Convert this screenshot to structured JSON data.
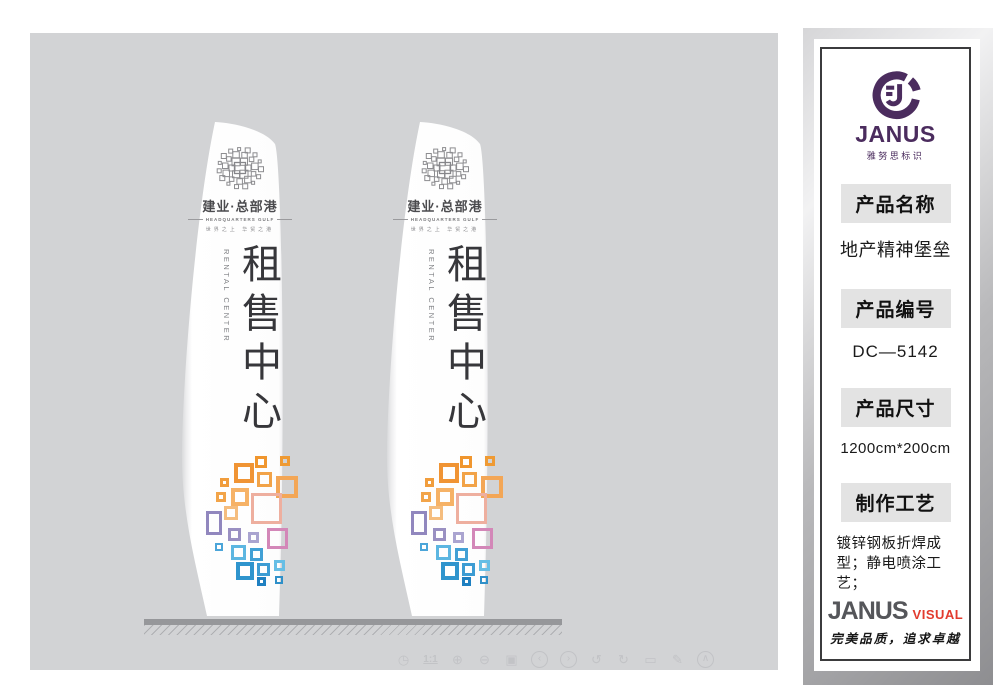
{
  "stage": {
    "background": "#d2d3d5",
    "sign": {
      "brand_name": "建业·总部港",
      "brand_sub": "HEADQUARTERS GULF",
      "brand_tagline": "世界之上 华贸之港",
      "title_cn": "租售中心",
      "title_en": "RENTAL CENTER"
    },
    "deco_squares": [
      {
        "x": 67,
        "y": 11,
        "s": 12,
        "b": 3,
        "c": "#f0962e"
      },
      {
        "x": 92,
        "y": 11,
        "s": 10,
        "b": 3,
        "c": "#ef9a33"
      },
      {
        "x": 46,
        "y": 18,
        "s": 20,
        "b": 4,
        "c": "#f09434"
      },
      {
        "x": 69,
        "y": 27,
        "s": 15,
        "b": 3,
        "c": "#f2a348"
      },
      {
        "x": 88,
        "y": 31,
        "s": 22,
        "b": 4,
        "c": "#f3a656"
      },
      {
        "x": 32,
        "y": 33,
        "s": 9,
        "b": 3,
        "c": "#f19d3c"
      },
      {
        "x": 28,
        "y": 47,
        "s": 10,
        "b": 3,
        "c": "#f2a449"
      },
      {
        "x": 43,
        "y": 43,
        "s": 18,
        "b": 4,
        "c": "#f6b266"
      },
      {
        "x": 63,
        "y": 48,
        "s": 31,
        "b": 3,
        "c": "#eeaf9f"
      },
      {
        "x": 36,
        "y": 61,
        "s": 14,
        "b": 3,
        "c": "#f5bd7e"
      },
      {
        "x": 18,
        "y": 66,
        "s": 16,
        "h": 24,
        "b": 3,
        "c": "#9187be"
      },
      {
        "x": 40,
        "y": 83,
        "s": 13,
        "b": 3,
        "c": "#9a90c2"
      },
      {
        "x": 60,
        "y": 87,
        "s": 11,
        "b": 3,
        "c": "#aaa4d0"
      },
      {
        "x": 79,
        "y": 83,
        "s": 21,
        "b": 3,
        "c": "#d387b8"
      },
      {
        "x": 27,
        "y": 98,
        "s": 8,
        "b": 2,
        "c": "#4ba5d9"
      },
      {
        "x": 43,
        "y": 100,
        "s": 15,
        "b": 3,
        "c": "#5cb6e1"
      },
      {
        "x": 62,
        "y": 103,
        "s": 13,
        "b": 3,
        "c": "#41a0d5"
      },
      {
        "x": 48,
        "y": 117,
        "s": 18,
        "b": 4,
        "c": "#2f94cd"
      },
      {
        "x": 69,
        "y": 118,
        "s": 13,
        "b": 3,
        "c": "#3c9cd3"
      },
      {
        "x": 86,
        "y": 115,
        "s": 11,
        "b": 3,
        "c": "#66bee5"
      },
      {
        "x": 69,
        "y": 132,
        "s": 9,
        "b": 3,
        "c": "#1f80c1"
      },
      {
        "x": 87,
        "y": 131,
        "s": 8,
        "b": 2,
        "c": "#2f90c9"
      }
    ],
    "toolbar": [
      {
        "name": "clock-icon",
        "glyph": "◷",
        "circle": false
      },
      {
        "name": "actual-size-label",
        "glyph": "1:1",
        "circle": false,
        "label": true
      },
      {
        "name": "zoom-in-icon",
        "glyph": "⊕",
        "circle": false
      },
      {
        "name": "zoom-out-icon",
        "glyph": "⊖",
        "circle": false
      },
      {
        "name": "image-frame-icon",
        "glyph": "▣",
        "circle": false
      },
      {
        "name": "prev-icon",
        "glyph": "‹",
        "circle": true
      },
      {
        "name": "next-icon",
        "glyph": "›",
        "circle": true
      },
      {
        "name": "undo-icon",
        "glyph": "↺",
        "circle": false
      },
      {
        "name": "redo-icon",
        "glyph": "↻",
        "circle": false
      },
      {
        "name": "trash-icon",
        "glyph": "▭",
        "circle": false
      },
      {
        "name": "edit-icon",
        "glyph": "✎",
        "circle": false
      },
      {
        "name": "collapse-icon",
        "glyph": "∧",
        "circle": true
      }
    ]
  },
  "sidebar": {
    "logo_brand": "JANUS",
    "logo_sub": "雅努思标识",
    "sections": [
      {
        "header": "产品名称",
        "value": "地产精神堡垒"
      },
      {
        "header": "产品编号",
        "value": "DC—5142"
      },
      {
        "header": "产品尺寸",
        "value": "1200cm*200cm"
      },
      {
        "header": "制作工艺",
        "value": "镀锌钢板折焊成型；静电喷涂工艺；"
      }
    ],
    "footer_brand": "JANUS",
    "footer_brand_accent": "VISUAL",
    "footer_slogan": "完美品质，追求卓越",
    "colors": {
      "brand_purple": "#4b2c5e",
      "accent_red": "#e23b2e",
      "header_bg": "#e3e3e3",
      "stage_gray": "#d2d3d5"
    }
  }
}
